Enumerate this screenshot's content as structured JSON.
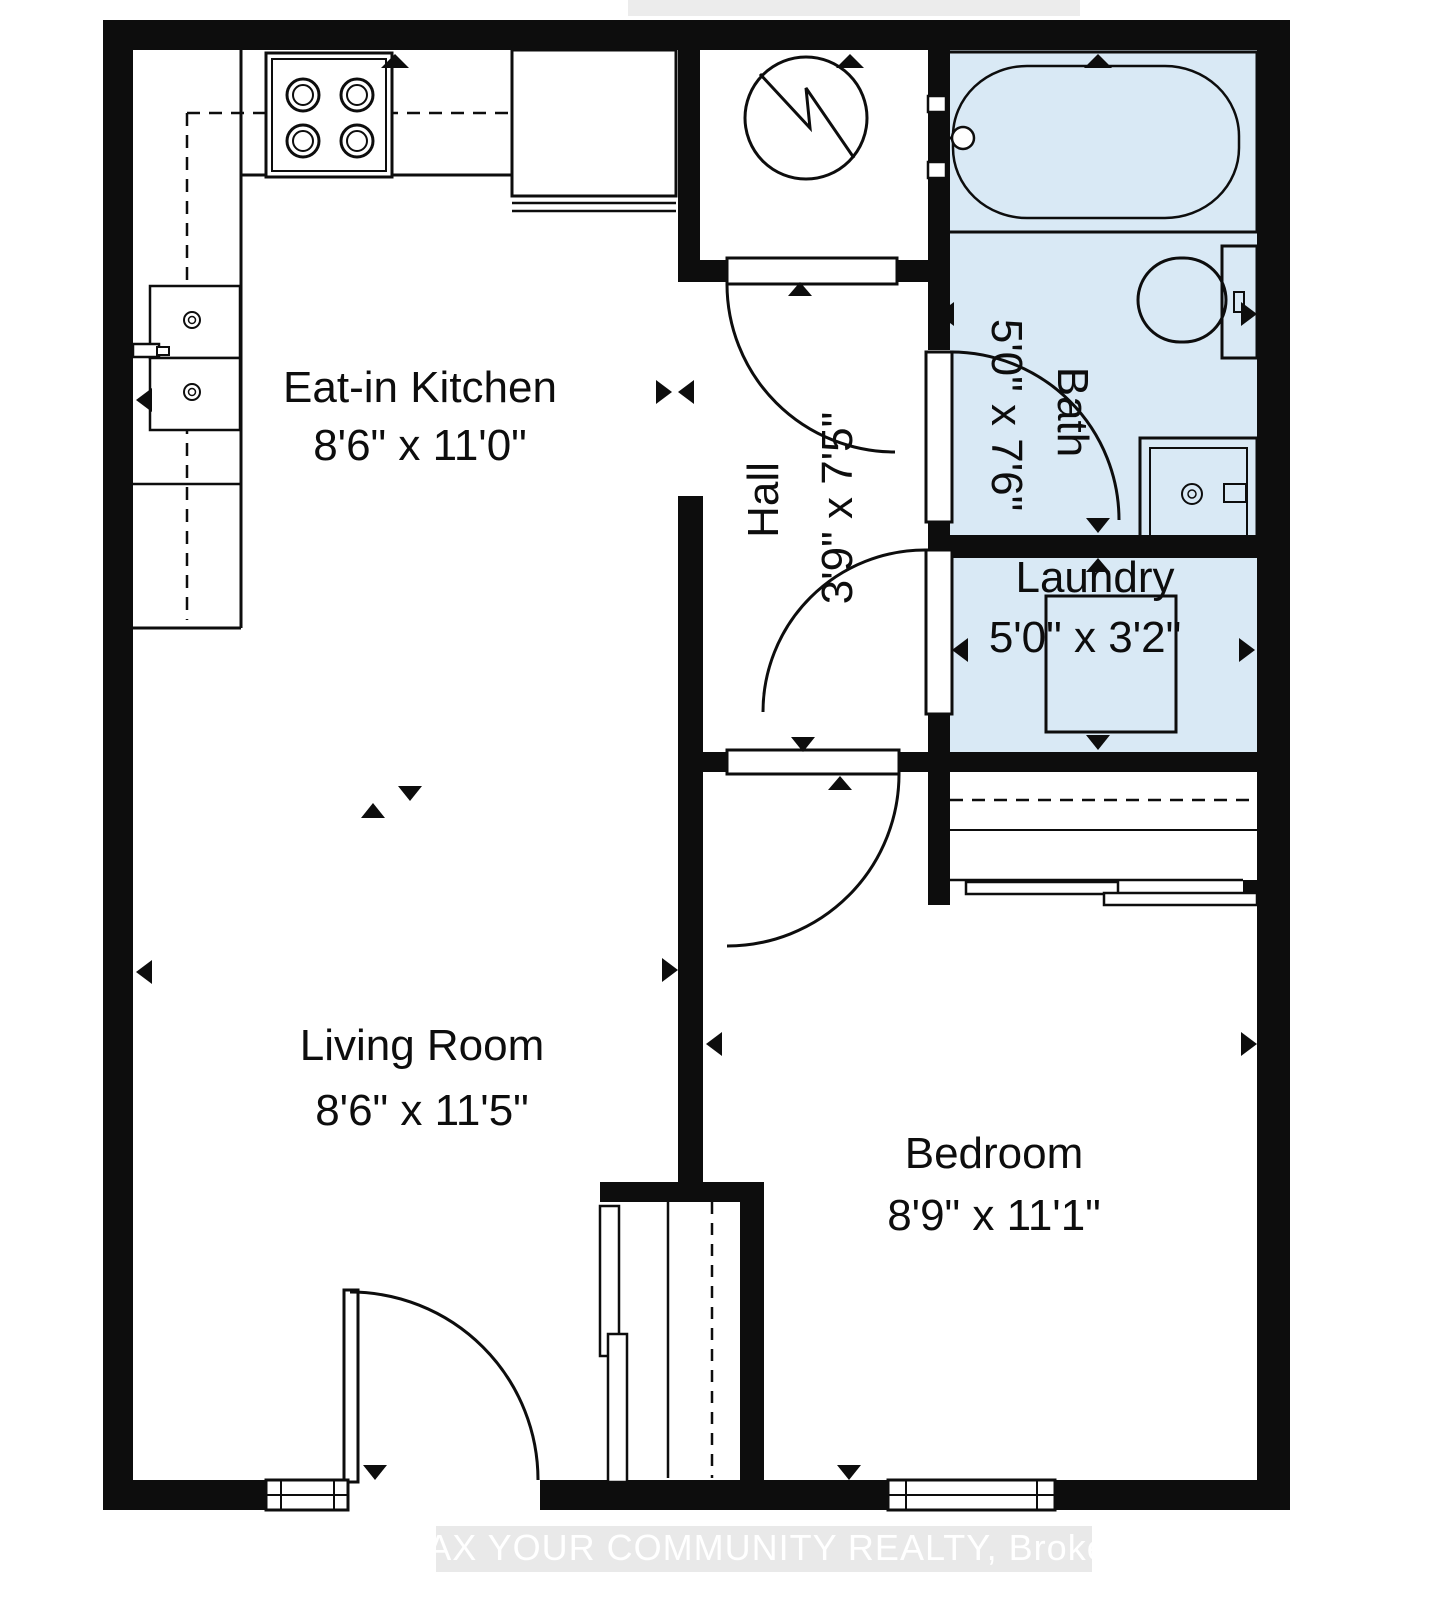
{
  "colors": {
    "wall": "#0d0d0d",
    "line": "#0d0d0d",
    "wet_room_fill": "#d9e9f5",
    "floor_fill": "#ffffff",
    "watermark_box": "#e9e9e9",
    "watermark_text": "#ffffff"
  },
  "rooms": {
    "kitchen": {
      "label": "Eat-in Kitchen",
      "dimensions": "8'6\" x 11'0\""
    },
    "hall": {
      "label": "Hall",
      "dimensions": "3'9\" x 7'5\""
    },
    "bath": {
      "label": "Bath",
      "dimensions": "5'0\" x 7'6\""
    },
    "laundry": {
      "label": "Laundry",
      "dimensions": "5'0\" x 3'2\""
    },
    "living": {
      "label": "Living Room",
      "dimensions": "8'6\" x 11'5\""
    },
    "bedroom": {
      "label": "Bedroom",
      "dimensions": "8'9\" x 11'1\""
    }
  },
  "fixtures": [
    "stove",
    "refrigerator",
    "kitchen-sink",
    "water-heater",
    "bathtub",
    "toilet",
    "vanity-sink",
    "washer"
  ],
  "watermark": {
    "text": "REMAX YOUR COMMUNITY REALTY, Brokerage"
  }
}
